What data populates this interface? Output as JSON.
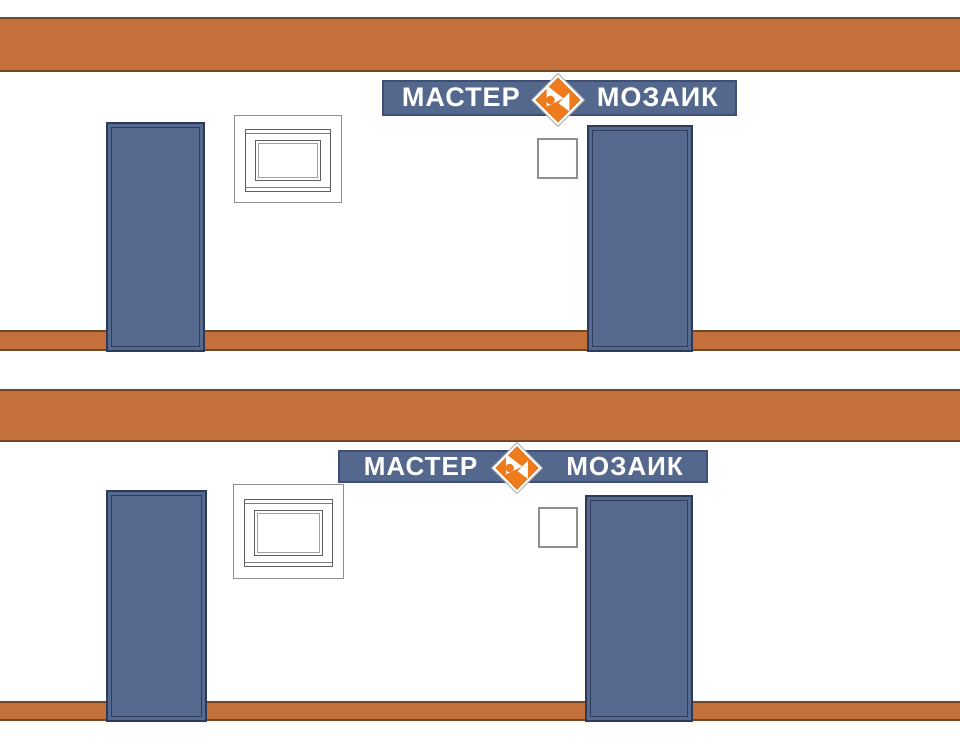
{
  "brand": {
    "name_left": "МАСТЕР",
    "name_right": "МОЗАИК"
  },
  "colors": {
    "band_orange": "#C4703A",
    "band_border": "#6E4827",
    "logo_orange": "#EE7C1C",
    "logo_orange_dark": "#D2650E",
    "sign_blue": "#54688E",
    "sign_border": "#3E4E74",
    "door_blue": "#56698F",
    "door_border": "#2E3A5A",
    "line_gray": "#8F8F8F",
    "wall_white": "#FFFFFF"
  },
  "panels": [
    {
      "sign": {
        "left": "МАСТЕР",
        "right": "МОЗАИК"
      }
    },
    {
      "sign": {
        "left": "МАСТЕР",
        "right": "МОЗАИК"
      }
    }
  ]
}
